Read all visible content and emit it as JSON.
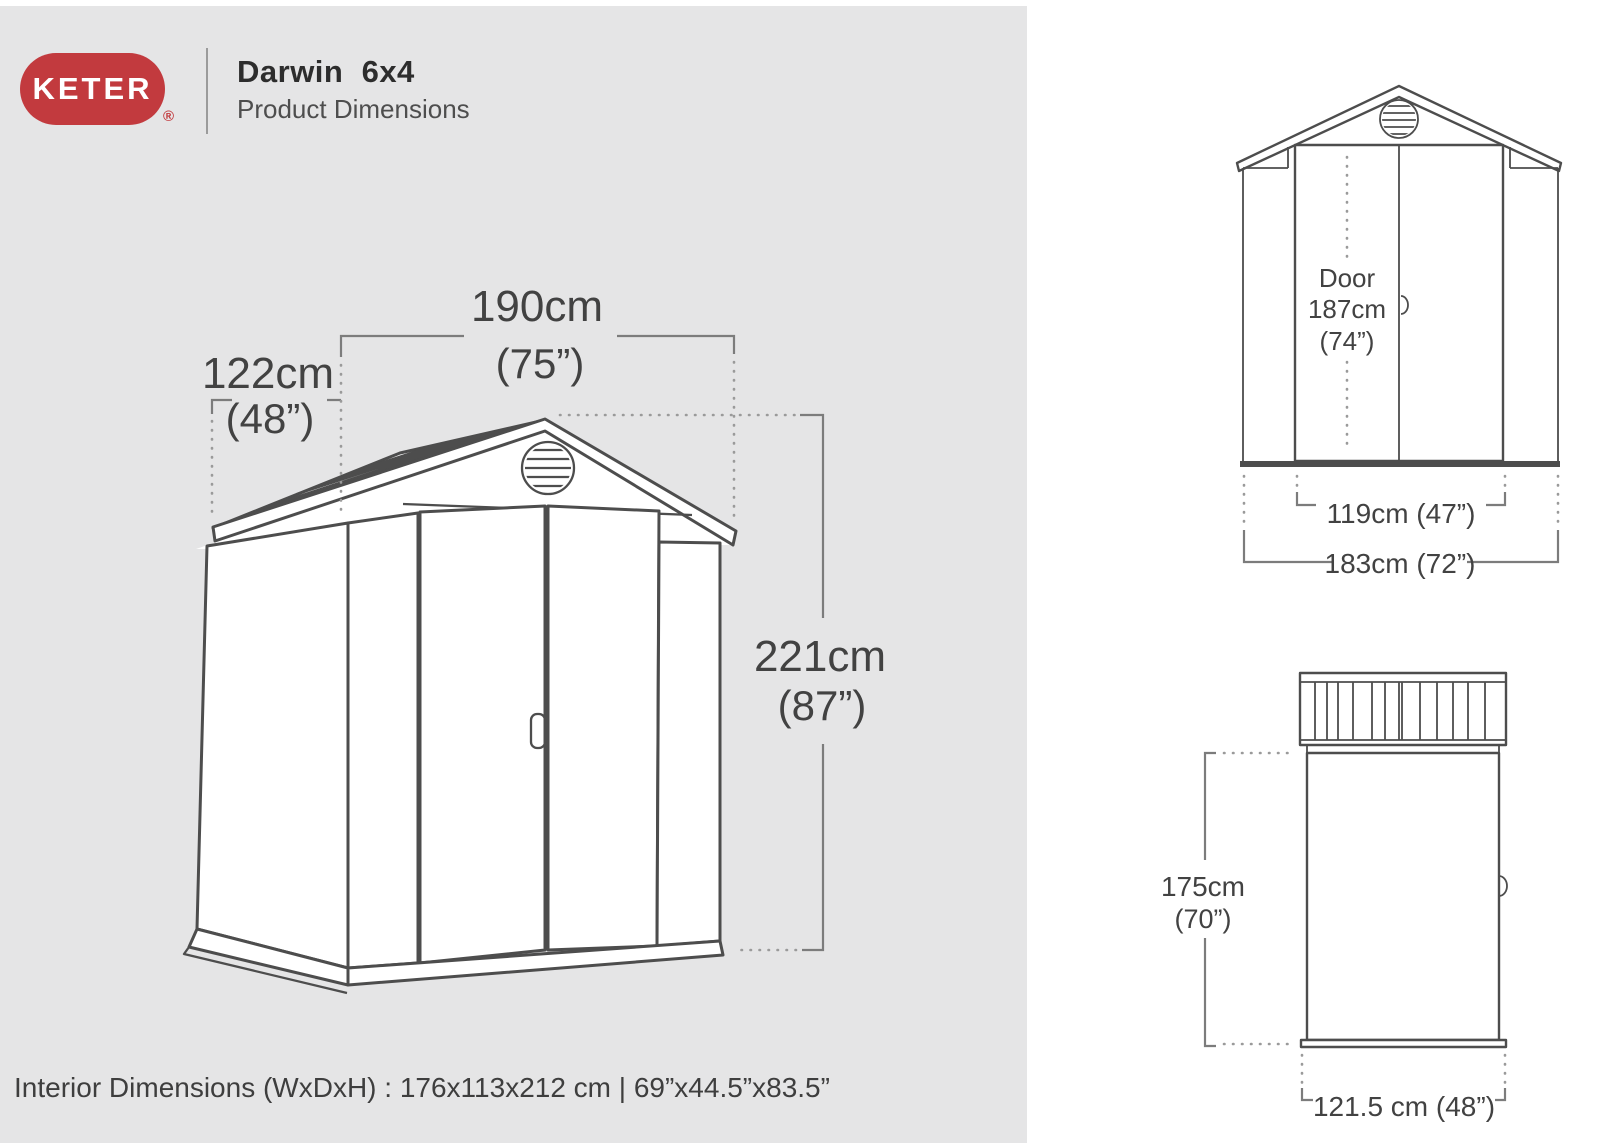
{
  "brand": {
    "logo_text": "KETER",
    "registered_mark": "®"
  },
  "header": {
    "product_name": "Darwin  6x4",
    "subtitle": "Product Dimensions"
  },
  "main_view": {
    "width": "190cm",
    "width_in": "(75”)",
    "depth": "122cm",
    "depth_in": "(48”)",
    "height": "221cm",
    "height_in": "(87”)"
  },
  "front_view": {
    "door_line1": "Door",
    "door_line2": "187cm",
    "door_line3": "(74”)",
    "door_width": "119cm (47”)",
    "total_width": "183cm (72”)"
  },
  "side_view": {
    "height": "175cm",
    "height_in": "(70”)",
    "depth": "121.5 cm (48”)"
  },
  "footer": {
    "interior_dimensions": "Interior Dimensions (WxDxH) : 176x113x212 cm | 69”x44.5”x83.5”"
  },
  "colors": {
    "brand_red": "#c23a3e",
    "panel_gray": "#e5e5e6",
    "line_dark": "#4d4d4d",
    "dim_gray": "#7c7c7c",
    "text_dark": "#424242"
  }
}
